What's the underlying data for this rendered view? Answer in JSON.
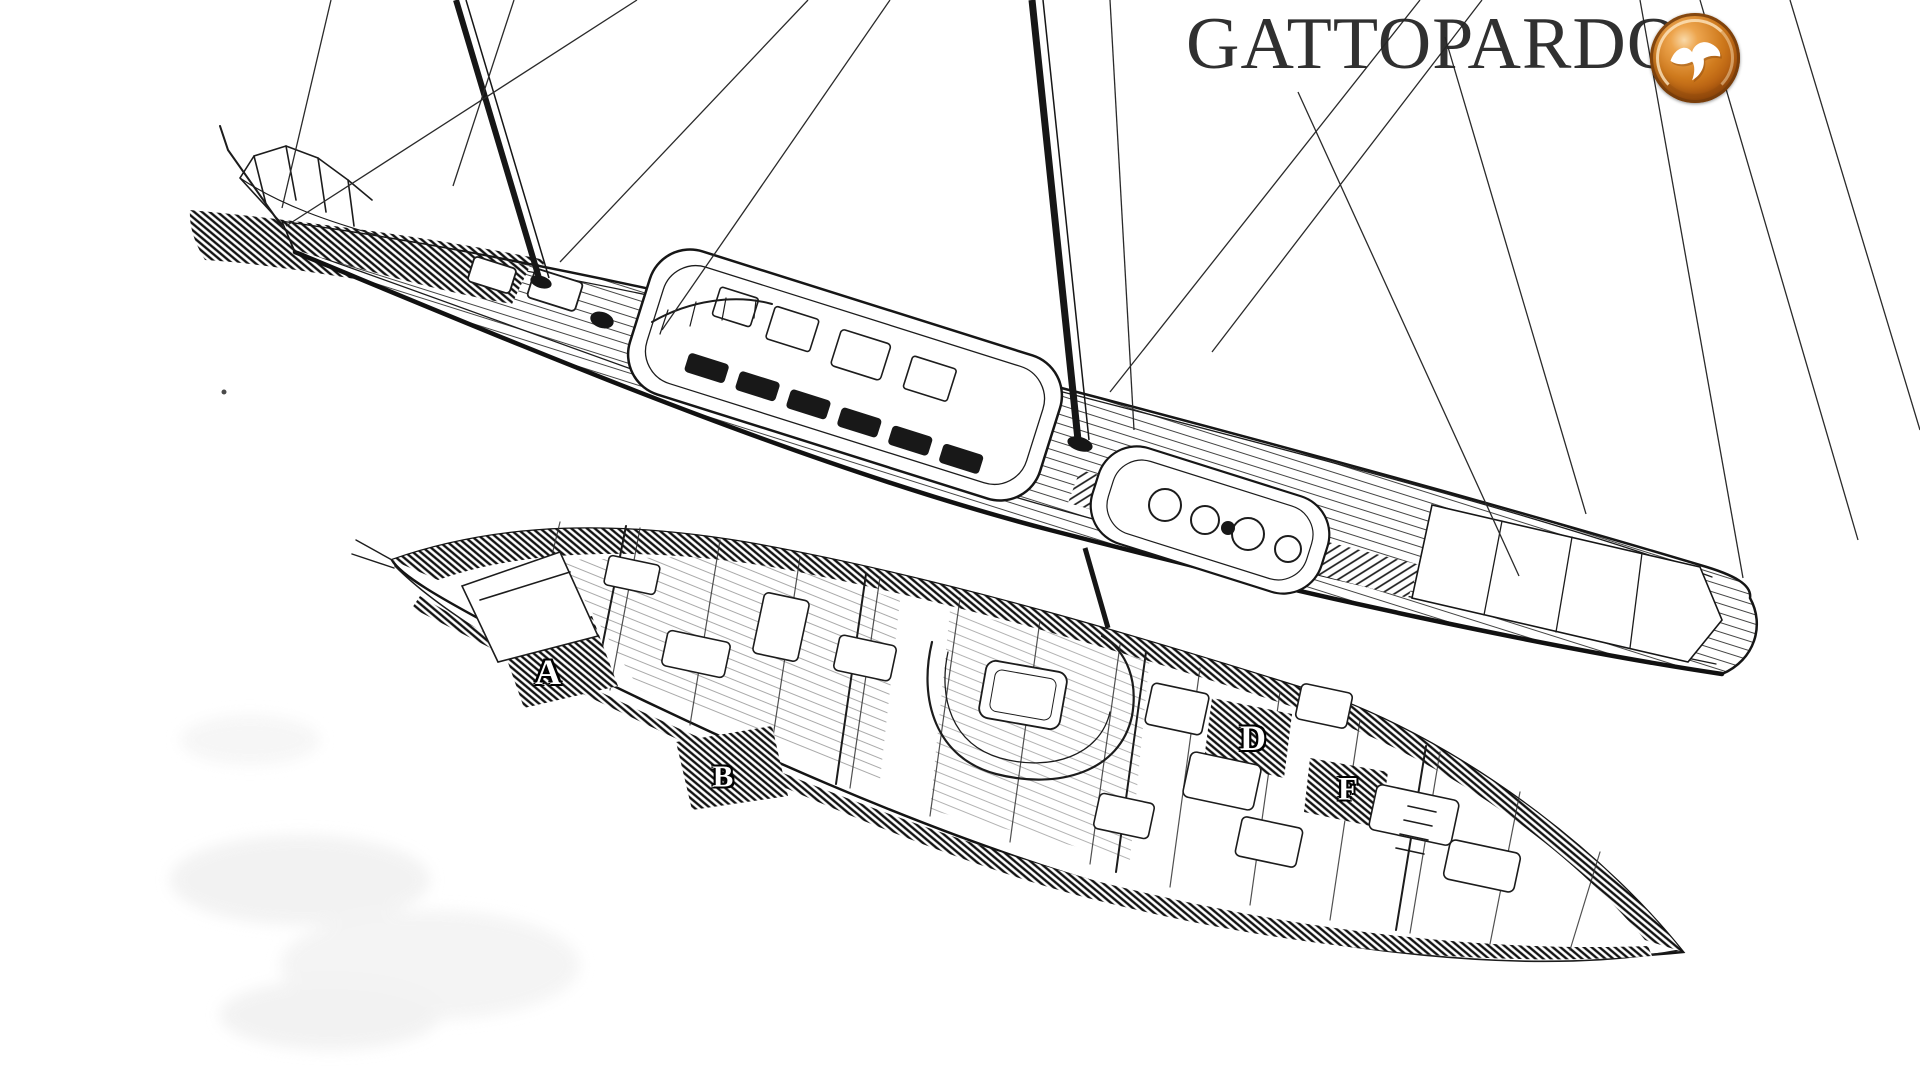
{
  "brand": {
    "title": "GATTOPARDO",
    "logo_icon": "seagull-icon",
    "logo_colors": {
      "rim": "#7e3f0c",
      "body": "#cf7a1d",
      "highlight": "#f9d9a8",
      "glyph": "#ffffff"
    }
  },
  "diagram": {
    "ink_color": "#1c1c1c",
    "views": [
      "deck-plan-perspective-view",
      "interior-cutaway-view"
    ],
    "compartment_labels": [
      {
        "letter": "A"
      },
      {
        "letter": "B"
      },
      {
        "letter": "D"
      },
      {
        "letter": "F"
      }
    ]
  }
}
